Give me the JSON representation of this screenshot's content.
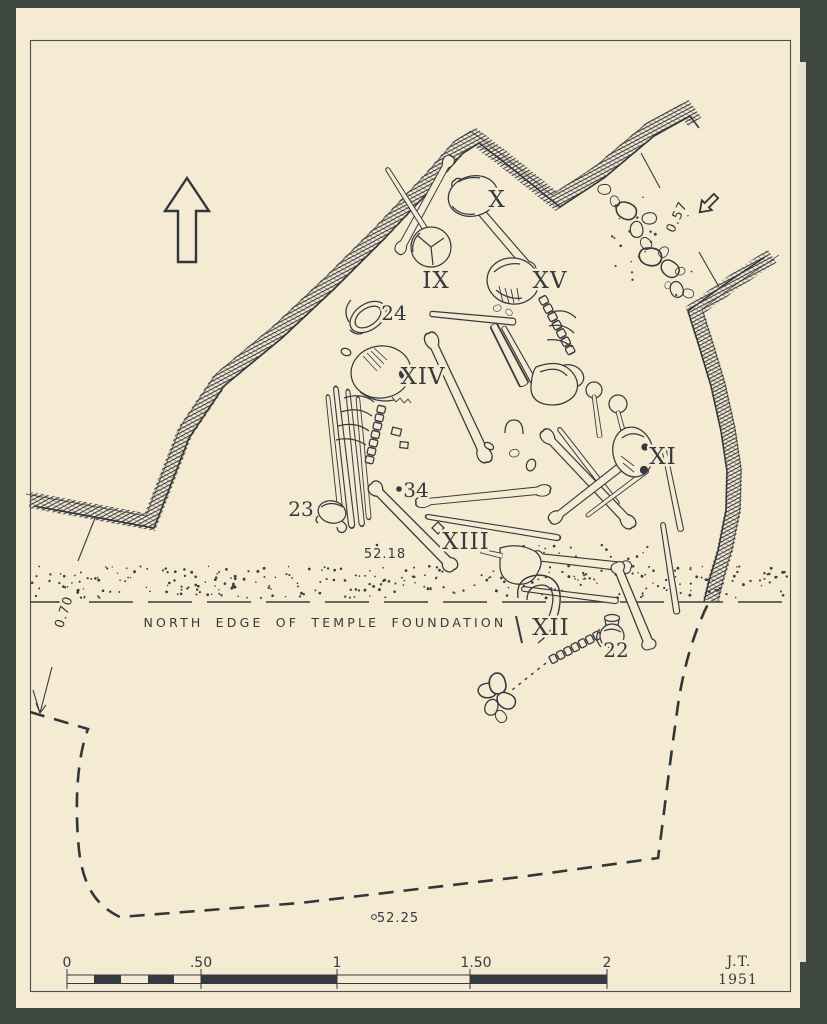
{
  "colors": {
    "background": "#3f4741",
    "paper": "#f5ead2",
    "ink": "#363a40"
  },
  "plan": {
    "caption": "NORTH EDGE OF TEMPLE FOUNDATION",
    "burial_labels": [
      "IX",
      "X",
      "XI",
      "XII",
      "XIII",
      "XIV",
      "XV"
    ],
    "find_labels": [
      "22",
      "23",
      "24",
      "34"
    ],
    "elevation_labels": [
      "52.18",
      "52.25",
      "0.57",
      "0.70"
    ]
  },
  "scale_bar": {
    "tick_labels": [
      "0",
      ".50",
      "1",
      "1.50",
      "2"
    ]
  },
  "signature": {
    "initials": "J.T.",
    "year": "1951"
  }
}
